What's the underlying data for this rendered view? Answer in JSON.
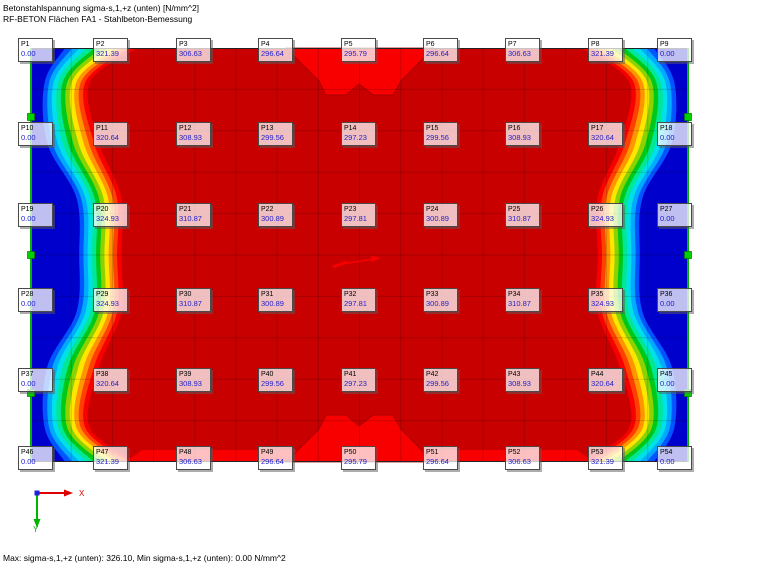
{
  "header": {
    "line1": "Betonstahlspannung sigma-s,1,+z (unten) [N/mm^2]",
    "line2": "RF-BETON Flächen FA1 - Stahlbeton-Bemessung"
  },
  "status": {
    "text": "Max: sigma-s,1,+z (unten): 326.10, Min sigma-s,1,+z (unten): 0.00 N/mm^2"
  },
  "axis": {
    "x_label": "X",
    "y_label": "Y",
    "x_color": "#dd0000",
    "y_color": "#00aa00",
    "origin_color": "#2222dd"
  },
  "chart_data": {
    "type": "heatmap",
    "title": "Betonstahlspannung sigma-s,1,+z (unten) [N/mm^2]",
    "subtitle": "RF-BETON Flächen FA1 - Stahlbeton-Bemessung",
    "unit": "N/mm^2",
    "max": 326.1,
    "min": 0.0,
    "grid": {
      "label_cols": 9,
      "label_rows": 6
    },
    "rows": [
      {
        "names": [
          "P1",
          "P2",
          "P3",
          "P4",
          "P5",
          "P6",
          "P7",
          "P8",
          "P9"
        ],
        "values": [
          "0.00",
          "321.39",
          "306.63",
          "296.64",
          "295.79",
          "296.64",
          "306.63",
          "321.39",
          "0.00"
        ]
      },
      {
        "names": [
          "P10",
          "P11",
          "P12",
          "P13",
          "P14",
          "P15",
          "P16",
          "P17",
          "P18"
        ],
        "values": [
          "0.00",
          "320.64",
          "308.93",
          "299.56",
          "297.23",
          "299.56",
          "308.93",
          "320.64",
          "0.00"
        ]
      },
      {
        "names": [
          "P19",
          "P20",
          "P21",
          "P22",
          "P23",
          "P24",
          "P25",
          "P26",
          "P27"
        ],
        "values": [
          "0.00",
          "324.93",
          "310.87",
          "300.89",
          "297.81",
          "300.89",
          "310.87",
          "324.93",
          "0.00"
        ]
      },
      {
        "names": [
          "P28",
          "P29",
          "P30",
          "P31",
          "P32",
          "P33",
          "P34",
          "P35",
          "P36"
        ],
        "values": [
          "0.00",
          "324.93",
          "310.87",
          "300.89",
          "297.81",
          "300.89",
          "310.87",
          "324.93",
          "0.00"
        ]
      },
      {
        "names": [
          "P37",
          "P38",
          "P39",
          "P40",
          "P41",
          "P42",
          "P43",
          "P44",
          "P45"
        ],
        "values": [
          "0.00",
          "320.64",
          "308.93",
          "299.56",
          "297.23",
          "299.56",
          "308.93",
          "320.64",
          "0.00"
        ]
      },
      {
        "names": [
          "P46",
          "P47",
          "P48",
          "P49",
          "P50",
          "P51",
          "P52",
          "P53",
          "P54"
        ],
        "values": [
          "0.00",
          "321.39",
          "306.63",
          "296.64",
          "295.79",
          "296.64",
          "306.63",
          "321.39",
          "0.00"
        ]
      }
    ]
  },
  "plot": {
    "width": 659,
    "height": 414,
    "base_color": "#c80000",
    "bright_color": "#f80000",
    "contour_outline": "#a00000",
    "band_colors": [
      "#0000cc",
      "#0055ff",
      "#00aaff",
      "#00e0e8",
      "#00e896",
      "#00c818",
      "#8cd200",
      "#ffe600",
      "#ff9600",
      "#ff4000",
      "#f80000"
    ],
    "profile": {
      "ys": [
        0,
        35,
        95,
        150,
        207,
        264,
        319,
        379,
        414
      ],
      "base": [
        28,
        10,
        12,
        42,
        45,
        42,
        12,
        10,
        28
      ],
      "step": [
        7.2,
        4.5,
        5.2,
        4.5,
        4.2,
        4.5,
        5.2,
        4.5,
        7.2
      ]
    },
    "mesh": {
      "nx": 16,
      "ny": 10,
      "line_color": "rgba(0,0,0,0.16)"
    },
    "edge_color": "#00b400",
    "edge_node_color": "#00d200",
    "marker_ys": [
      69,
      207,
      345
    ],
    "notch": [
      [
        256,
        0
      ],
      [
        289,
        33
      ],
      [
        296,
        47
      ],
      [
        316,
        47
      ],
      [
        329,
        36
      ],
      [
        343,
        47
      ],
      [
        363,
        47
      ],
      [
        371,
        33
      ],
      [
        403,
        0
      ]
    ],
    "bottom_strip": [
      [
        96,
        414
      ],
      [
        112,
        402
      ],
      [
        547,
        402
      ],
      [
        563,
        414
      ]
    ]
  }
}
